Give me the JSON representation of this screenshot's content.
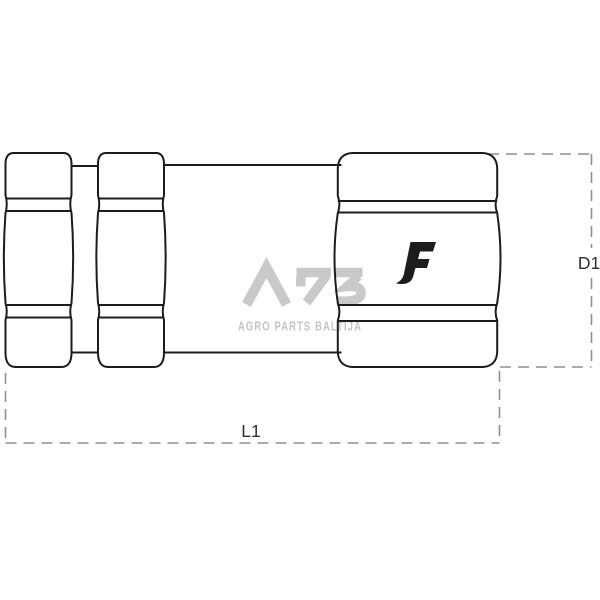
{
  "watermark": {
    "logo_text": "APB",
    "subtitle": "AGRO PARTS BALTIJA",
    "logo_color": "#c9c9c9",
    "subtitle_color": "#c4c4c4"
  },
  "brand_mark": {
    "letter": "F",
    "color": "#1c1c1c"
  },
  "dimension_labels": {
    "length": "L1",
    "diameter": "D1"
  },
  "colors": {
    "drawing_line": "#1c1c1c",
    "dimension_line": "#8f8f8f",
    "dimension_label": "#2f2f2f",
    "background": "#ffffff"
  }
}
